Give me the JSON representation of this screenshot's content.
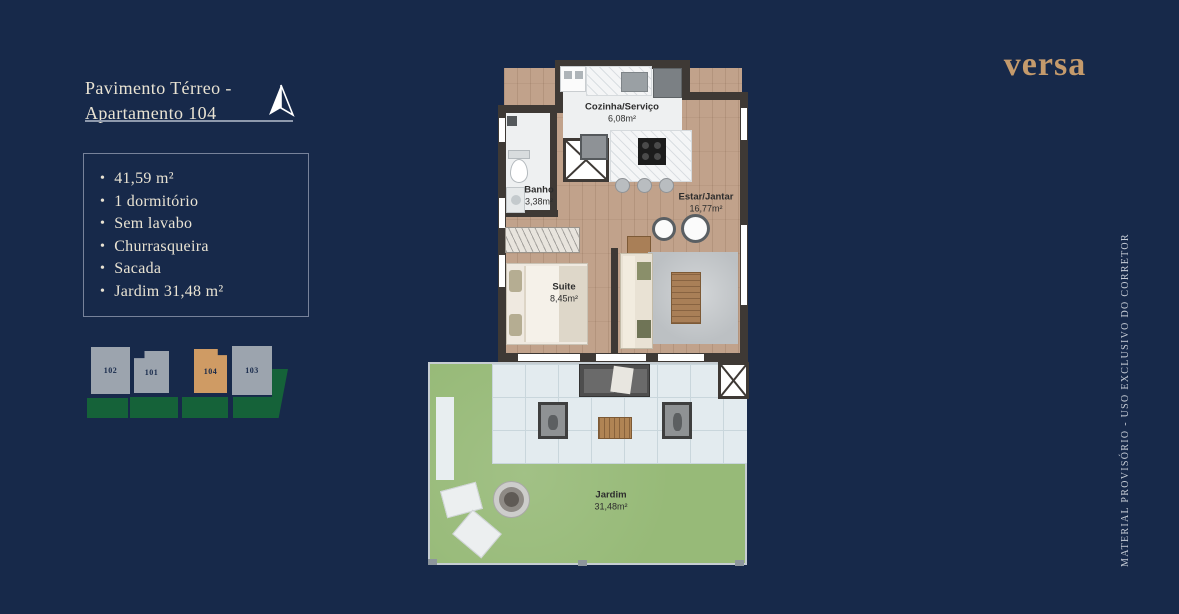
{
  "header": {
    "title_line1": "Pavimento Térreo -",
    "title_line2": "Apartamento 104"
  },
  "brand": {
    "logo_text": "versa"
  },
  "features": {
    "items": [
      "41,59 m²",
      "1 dormitório",
      "Sem lavabo",
      "Churrasqueira",
      "Sacada",
      "Jardim 31,48 m²"
    ]
  },
  "site_plan": {
    "units": [
      {
        "id": "102",
        "highlighted": false
      },
      {
        "id": "101",
        "highlighted": false
      },
      {
        "id": "104",
        "highlighted": true
      },
      {
        "id": "103",
        "highlighted": false
      }
    ]
  },
  "floor_plan": {
    "rooms": [
      {
        "name": "Cozinha/Serviço",
        "area": "6,08m²"
      },
      {
        "name": "Banho",
        "area": "3,38m²"
      },
      {
        "name": "Estar/Jantar",
        "area": "16,77m²"
      },
      {
        "name": "Suite",
        "area": "8,45m²"
      },
      {
        "name": "Jardim",
        "area": "31,48m²"
      }
    ]
  },
  "disclaimer": {
    "text": "MATERIAL PROVISÓRIO - USO EXCLUSIVO DO CORRETOR"
  },
  "colors": {
    "background": "#17294a",
    "accent_gold": "#c49a6c",
    "unit_highlight": "#cf9b64",
    "unit_gray": "#9ca4ae",
    "lawn_green": "#156239",
    "text_cream": "#e9e3d3"
  }
}
